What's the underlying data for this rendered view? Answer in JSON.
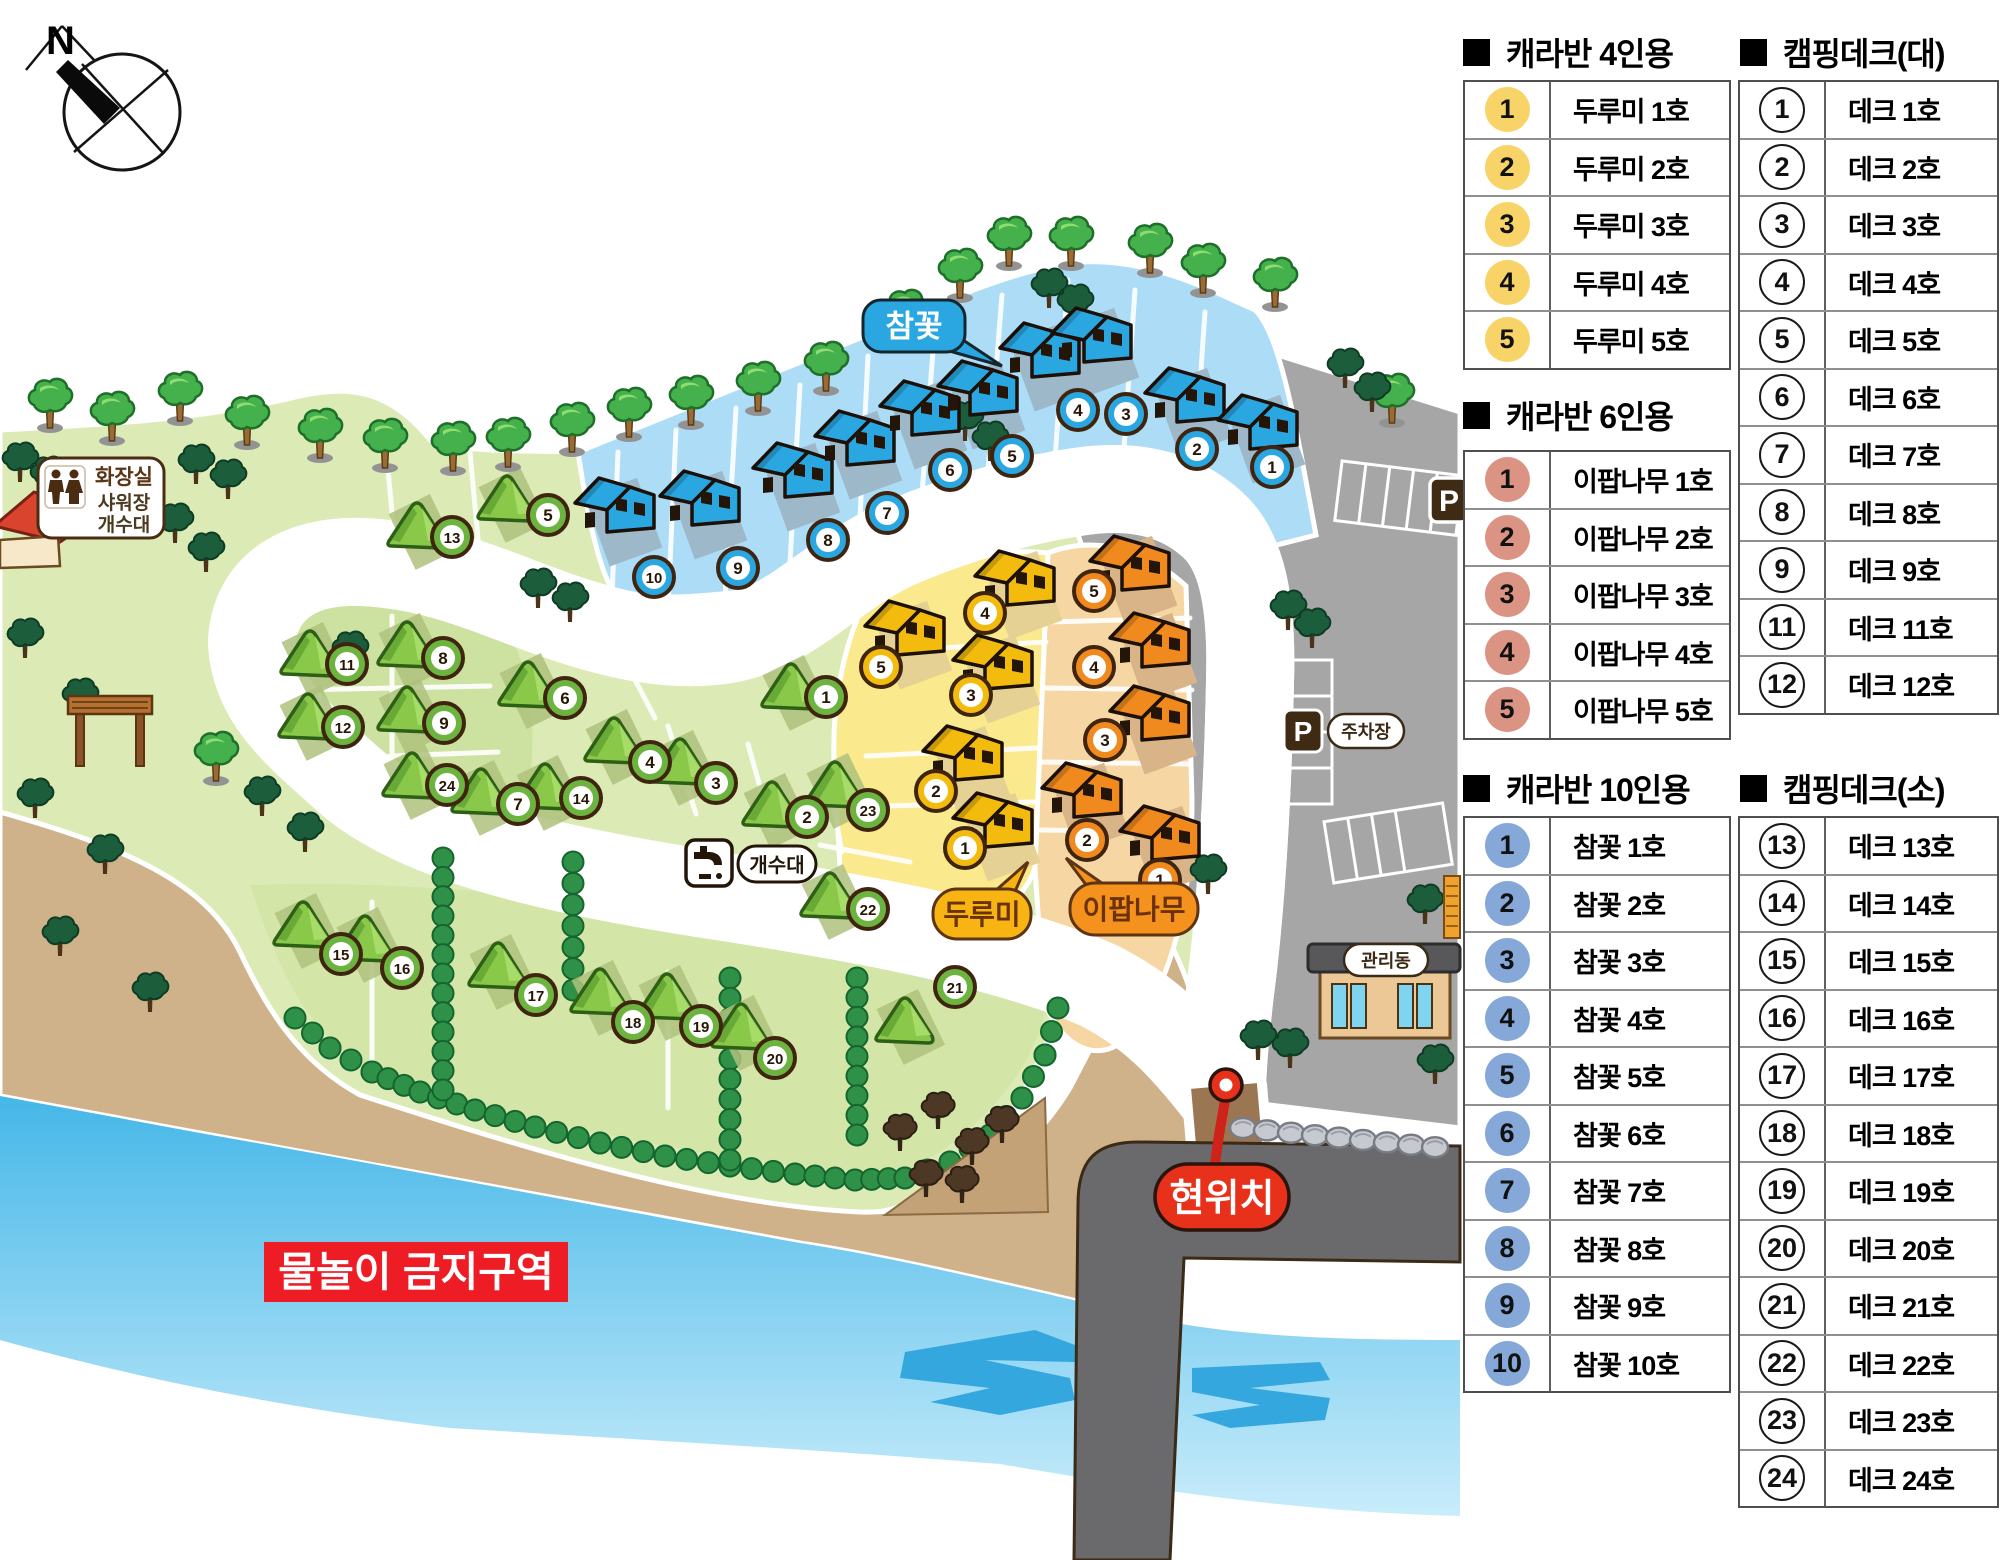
{
  "colors": {
    "blue_caravan": "#2aa7e0",
    "yellow_caravan": "#f2bb0e",
    "orange_caravan": "#f08a1e",
    "green_deck": "#6cb33f",
    "legend_yellow": "#f8d468",
    "legend_pink": "#db9383",
    "legend_blue": "#85a8d8",
    "river": "#4fbdeb",
    "sand": "#cfb18a",
    "meadow": "#dcebb6",
    "road_brown": "#9b7653",
    "road_dark": "#6a6a6c",
    "alert_red": "#ee1c25",
    "pin_red": "#e8311a"
  },
  "compass": {
    "north": "N"
  },
  "facility": {
    "toilet_sign": [
      "화장실",
      "샤워장",
      "개수대"
    ],
    "sink_label": "개수대",
    "parking_label": "주차장",
    "parking_symbol": "P",
    "management_label": "관리동",
    "current_location": "현위치",
    "no_swim_zone": "물놀이 금지구역"
  },
  "area_labels": {
    "blue": "참꽃",
    "yellow": "두루미",
    "orange": "이팝나무"
  },
  "legend": {
    "sections": [
      {
        "title": "캐라반 4인용",
        "style": "filled",
        "color": "#f8d468",
        "items": [
          {
            "num": "1",
            "label": "두루미 1호"
          },
          {
            "num": "2",
            "label": "두루미 2호"
          },
          {
            "num": "3",
            "label": "두루미 3호"
          },
          {
            "num": "4",
            "label": "두루미 4호"
          },
          {
            "num": "5",
            "label": "두루미 5호"
          }
        ]
      },
      {
        "title": "캠핑데크(대)",
        "style": "outline",
        "color": "#ffffff",
        "items": [
          {
            "num": "1",
            "label": "데크 1호"
          },
          {
            "num": "2",
            "label": "데크 2호"
          },
          {
            "num": "3",
            "label": "데크 3호"
          },
          {
            "num": "4",
            "label": "데크 4호"
          },
          {
            "num": "5",
            "label": "데크 5호"
          },
          {
            "num": "6",
            "label": "데크 6호"
          },
          {
            "num": "7",
            "label": "데크 7호"
          },
          {
            "num": "8",
            "label": "데크 8호"
          },
          {
            "num": "9",
            "label": "데크 9호"
          },
          {
            "num": "11",
            "label": "데크 11호"
          },
          {
            "num": "12",
            "label": "데크 12호"
          }
        ]
      },
      {
        "title": "캐라반 6인용",
        "style": "filled",
        "color": "#db9383",
        "items": [
          {
            "num": "1",
            "label": "이팝나무 1호"
          },
          {
            "num": "2",
            "label": "이팝나무 2호"
          },
          {
            "num": "3",
            "label": "이팝나무 3호"
          },
          {
            "num": "4",
            "label": "이팝나무 4호"
          },
          {
            "num": "5",
            "label": "이팝나무 5호"
          }
        ]
      },
      {
        "title": "캐라반 10인용",
        "style": "filled",
        "color": "#85a8d8",
        "items": [
          {
            "num": "1",
            "label": "참꽃 1호"
          },
          {
            "num": "2",
            "label": "참꽃 2호"
          },
          {
            "num": "3",
            "label": "참꽃 3호"
          },
          {
            "num": "4",
            "label": "참꽃 4호"
          },
          {
            "num": "5",
            "label": "참꽃 5호"
          },
          {
            "num": "6",
            "label": "참꽃 6호"
          },
          {
            "num": "7",
            "label": "참꽃 7호"
          },
          {
            "num": "8",
            "label": "참꽃 8호"
          },
          {
            "num": "9",
            "label": "참꽃 9호"
          },
          {
            "num": "10",
            "label": "참꽃 10호"
          }
        ]
      },
      {
        "title": "캠핑데크(소)",
        "style": "outline",
        "color": "#ffffff",
        "items": [
          {
            "num": "13",
            "label": "데크 13호"
          },
          {
            "num": "14",
            "label": "데크 14호"
          },
          {
            "num": "15",
            "label": "데크 15호"
          },
          {
            "num": "16",
            "label": "데크 16호"
          },
          {
            "num": "17",
            "label": "데크 17호"
          },
          {
            "num": "18",
            "label": "데크 18호"
          },
          {
            "num": "19",
            "label": "데크 19호"
          },
          {
            "num": "20",
            "label": "데크 20호"
          },
          {
            "num": "21",
            "label": "데크 21호"
          },
          {
            "num": "22",
            "label": "데크 22호"
          },
          {
            "num": "23",
            "label": "데크 23호"
          },
          {
            "num": "24",
            "label": "데크 24호"
          }
        ]
      }
    ]
  },
  "map_markers": {
    "blue": [
      {
        "num": "1",
        "x": 1272,
        "y": 467
      },
      {
        "num": "2",
        "x": 1197,
        "y": 449
      },
      {
        "num": "3",
        "x": 1126,
        "y": 414
      },
      {
        "num": "4",
        "x": 1078,
        "y": 410
      },
      {
        "num": "5",
        "x": 1012,
        "y": 456
      },
      {
        "num": "6",
        "x": 950,
        "y": 470
      },
      {
        "num": "7",
        "x": 887,
        "y": 513
      },
      {
        "num": "8",
        "x": 828,
        "y": 540
      },
      {
        "num": "9",
        "x": 738,
        "y": 568
      },
      {
        "num": "10",
        "x": 654,
        "y": 577
      }
    ],
    "yellow": [
      {
        "num": "1",
        "x": 965,
        "y": 848
      },
      {
        "num": "2",
        "x": 936,
        "y": 791
      },
      {
        "num": "3",
        "x": 971,
        "y": 695
      },
      {
        "num": "4",
        "x": 985,
        "y": 613
      },
      {
        "num": "5",
        "x": 881,
        "y": 667
      }
    ],
    "orange": [
      {
        "num": "1",
        "x": 1160,
        "y": 880
      },
      {
        "num": "2",
        "x": 1087,
        "y": 840
      },
      {
        "num": "3",
        "x": 1105,
        "y": 740
      },
      {
        "num": "4",
        "x": 1094,
        "y": 667
      },
      {
        "num": "5",
        "x": 1094,
        "y": 591
      }
    ],
    "green": [
      {
        "num": "1",
        "x": 826,
        "y": 697
      },
      {
        "num": "2",
        "x": 807,
        "y": 817
      },
      {
        "num": "3",
        "x": 716,
        "y": 783
      },
      {
        "num": "4",
        "x": 650,
        "y": 762
      },
      {
        "num": "5",
        "x": 548,
        "y": 515
      },
      {
        "num": "6",
        "x": 565,
        "y": 698
      },
      {
        "num": "7",
        "x": 518,
        "y": 804
      },
      {
        "num": "8",
        "x": 443,
        "y": 658
      },
      {
        "num": "9",
        "x": 444,
        "y": 723
      },
      {
        "num": "11",
        "x": 347,
        "y": 664
      },
      {
        "num": "12",
        "x": 343,
        "y": 727
      },
      {
        "num": "13",
        "x": 452,
        "y": 537
      },
      {
        "num": "14",
        "x": 581,
        "y": 798
      },
      {
        "num": "15",
        "x": 341,
        "y": 954
      },
      {
        "num": "16",
        "x": 402,
        "y": 968
      },
      {
        "num": "17",
        "x": 536,
        "y": 995
      },
      {
        "num": "18",
        "x": 633,
        "y": 1022
      },
      {
        "num": "19",
        "x": 701,
        "y": 1026
      },
      {
        "num": "20",
        "x": 775,
        "y": 1058
      },
      {
        "num": "21",
        "x": 955,
        "y": 987
      },
      {
        "num": "22",
        "x": 868,
        "y": 909
      },
      {
        "num": "23",
        "x": 868,
        "y": 810
      },
      {
        "num": "24",
        "x": 447,
        "y": 785
      }
    ]
  }
}
